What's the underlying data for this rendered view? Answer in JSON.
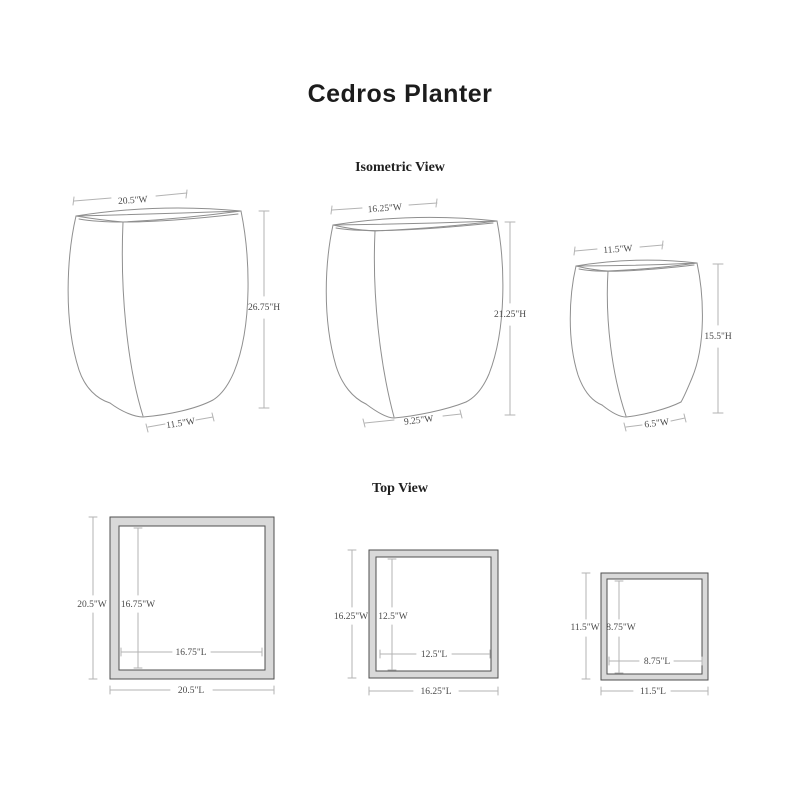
{
  "title": "Cedros Planter",
  "isometric": {
    "heading": "Isometric View",
    "planters": [
      {
        "top_width": "20.5\"W",
        "height": "26.75\"H",
        "bottom_width": "11.5\"W"
      },
      {
        "top_width": "16.25\"W",
        "height": "21.25\"H",
        "bottom_width": "9.25\"W"
      },
      {
        "top_width": "11.5\"W",
        "height": "15.5\"H",
        "bottom_width": "6.5\"W"
      }
    ]
  },
  "top_view": {
    "heading": "Top View",
    "planters": [
      {
        "outer_width": "20.5\"W",
        "outer_length": "20.5\"L",
        "inner_width": "16.75\"W",
        "inner_length": "16.75\"L"
      },
      {
        "outer_width": "16.25\"W",
        "outer_length": "16.25\"L",
        "inner_width": "12.5\"W",
        "inner_length": "12.5\"L"
      },
      {
        "outer_width": "11.5\"W",
        "outer_length": "11.5\"L",
        "inner_width": "8.75\"W",
        "inner_length": "8.75\"L"
      }
    ]
  },
  "colors": {
    "background": "#ffffff",
    "drawing_line": "#8f8f8f",
    "dimension_line": "#b3b3b3",
    "label_text": "#4a4a4a",
    "frame_fill": "#d9d9d9",
    "frame_stroke": "#4f4f4f",
    "heading_text": "#1c1c1c"
  }
}
